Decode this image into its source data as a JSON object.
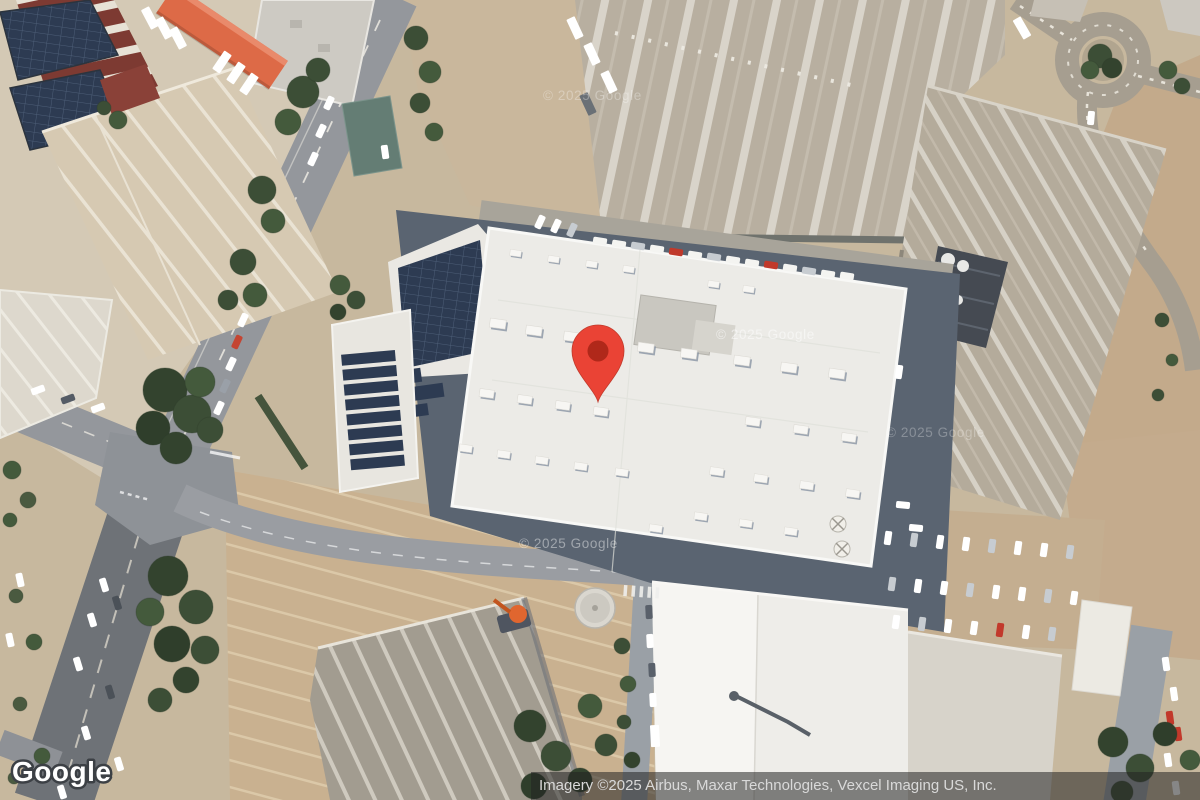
{
  "branding": {
    "logo": "Google"
  },
  "attribution": {
    "text": "Imagery ©2025 Airbus, Maxar Technologies, Vexcel Imaging US, Inc."
  },
  "watermark": {
    "text": "© 2025 Google"
  },
  "pin": {
    "color": "#EA4335",
    "inner_color": "#B0281A"
  }
}
